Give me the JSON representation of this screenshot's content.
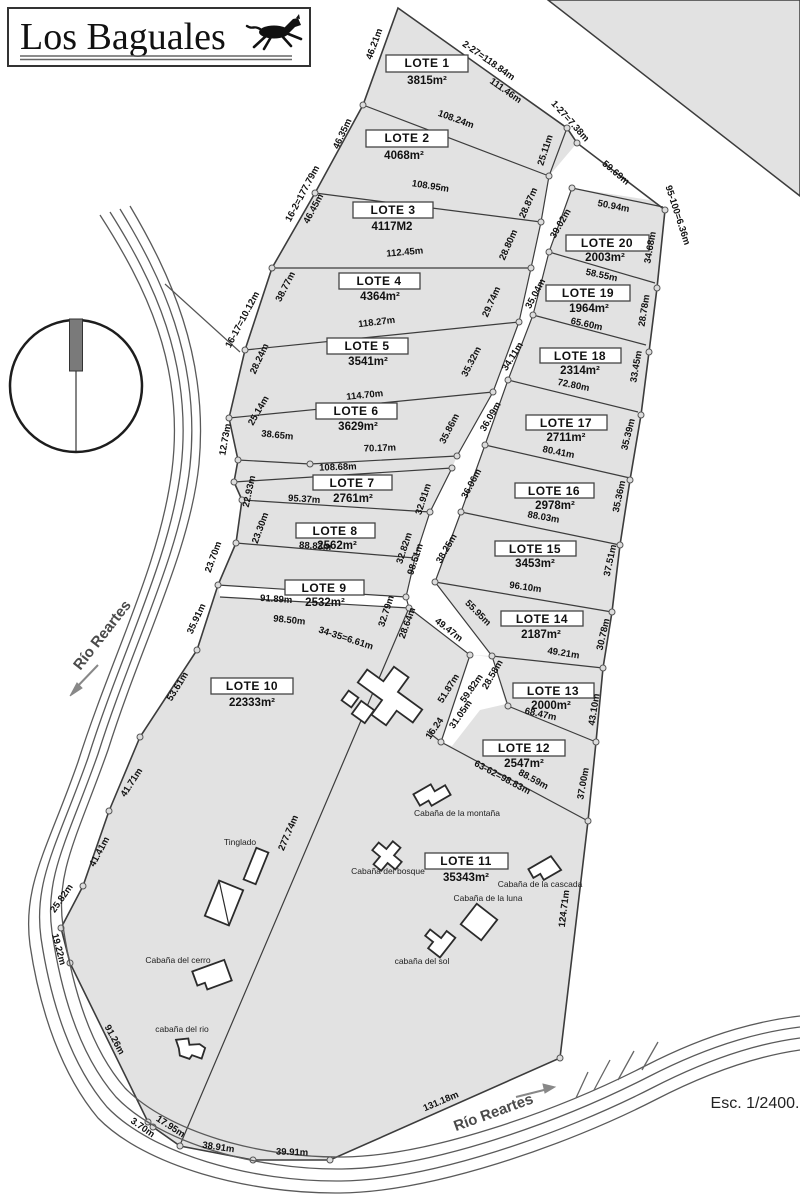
{
  "title": "Los Baguales",
  "scale_label": "Esc. 1/2400.",
  "river": {
    "label_upper": "Río Reartes",
    "label_lower": "Río Reartes"
  },
  "colors": {
    "land": "#e2e2e2",
    "outline": "#3c3c3c",
    "label_box": "#ffffff",
    "text": "#111111",
    "river": "#5a5a5a",
    "compass_bar": "#7a7a7a"
  },
  "lots": [
    {
      "label": "LOTE 1",
      "area": "3815m²"
    },
    {
      "label": "LOTE 2",
      "area": "4068m²"
    },
    {
      "label": "LOTE 3",
      "area": "4117M2"
    },
    {
      "label": "LOTE 4",
      "area": "4364m²"
    },
    {
      "label": "LOTE 5",
      "area": "3541m²"
    },
    {
      "label": "LOTE 6",
      "area": "3629m²"
    },
    {
      "label": "LOTE 7",
      "area": "2761m²"
    },
    {
      "label": "LOTE 8",
      "area": "2562m²"
    },
    {
      "label": "LOTE 9",
      "area": "2532m²"
    },
    {
      "label": "LOTE 10",
      "area": "22333m²"
    },
    {
      "label": "LOTE 11",
      "area": "35343m²"
    },
    {
      "label": "LOTE 12",
      "area": "2547m²"
    },
    {
      "label": "LOTE 13",
      "area": "2000m²"
    },
    {
      "label": "LOTE 14",
      "area": "2187m²"
    },
    {
      "label": "LOTE 15",
      "area": "3453m²"
    },
    {
      "label": "LOTE 16",
      "area": "2978m²"
    },
    {
      "label": "LOTE 17",
      "area": "2711m²"
    },
    {
      "label": "LOTE 18",
      "area": "2314m²"
    },
    {
      "label": "LOTE 19",
      "area": "1964m²"
    },
    {
      "label": "LOTE 20",
      "area": "2003m²"
    }
  ],
  "cabins": [
    "Tinglado",
    "Cabaña del cerro",
    "cabaña del rio",
    "Cabaña de la montaña",
    "Cabaña del bosque",
    "Cabaña de la cascada",
    "Cabaña de la luna",
    "cabaña del sol"
  ],
  "dims": [
    "46.21m",
    "2-27=118.84m",
    "111.46m",
    "108.24m",
    "1-27=7.38m",
    "59.69m",
    "46.35m",
    "25.11m",
    "108.95m",
    "28.87m",
    "16-2=177.79m",
    "46.45m",
    "50.94m",
    "95-100=6.36m",
    "39.02m",
    "34.68m",
    "112.45m",
    "28.80m",
    "58.55m",
    "38.77m",
    "35.04m",
    "29.74m",
    "28.78m",
    "118.27m",
    "65.60m",
    "16-17=10.12m",
    "34.11m",
    "35.32m",
    "28.24m",
    "33.45m",
    "72.80m",
    "114.70m",
    "36.09m",
    "25.14m",
    "35.86m",
    "35.39m",
    "38.65m",
    "12.73m",
    "70.17m",
    "80.41m",
    "108.68m",
    "36.06m",
    "22.93m",
    "32.91m",
    "35.36m",
    "95.37m",
    "88.03m",
    "23.30m",
    "32.82m",
    "98.51m",
    "38.25m",
    "88.83m",
    "37.51m",
    "23.70m",
    "96.10m",
    "91.89m",
    "32.79m",
    "98.50m",
    "34-35=6.61m",
    "28.64m",
    "55.95m",
    "30.78m",
    "49.47m",
    "49.21m",
    "35.91m",
    "28.58m",
    "51.87m",
    "59.82m",
    "43.10m",
    "53.61m",
    "31.05m",
    "16.24",
    "68.47m",
    "63-62=98.83m",
    "88.59m",
    "37.00m",
    "41.71m",
    "277.74m",
    "41.41m",
    "124.71m",
    "25.82m",
    "19.22m",
    "91.26m",
    "3.70m",
    "17.95m",
    "38.91m",
    "39.91m",
    "131.18m"
  ]
}
